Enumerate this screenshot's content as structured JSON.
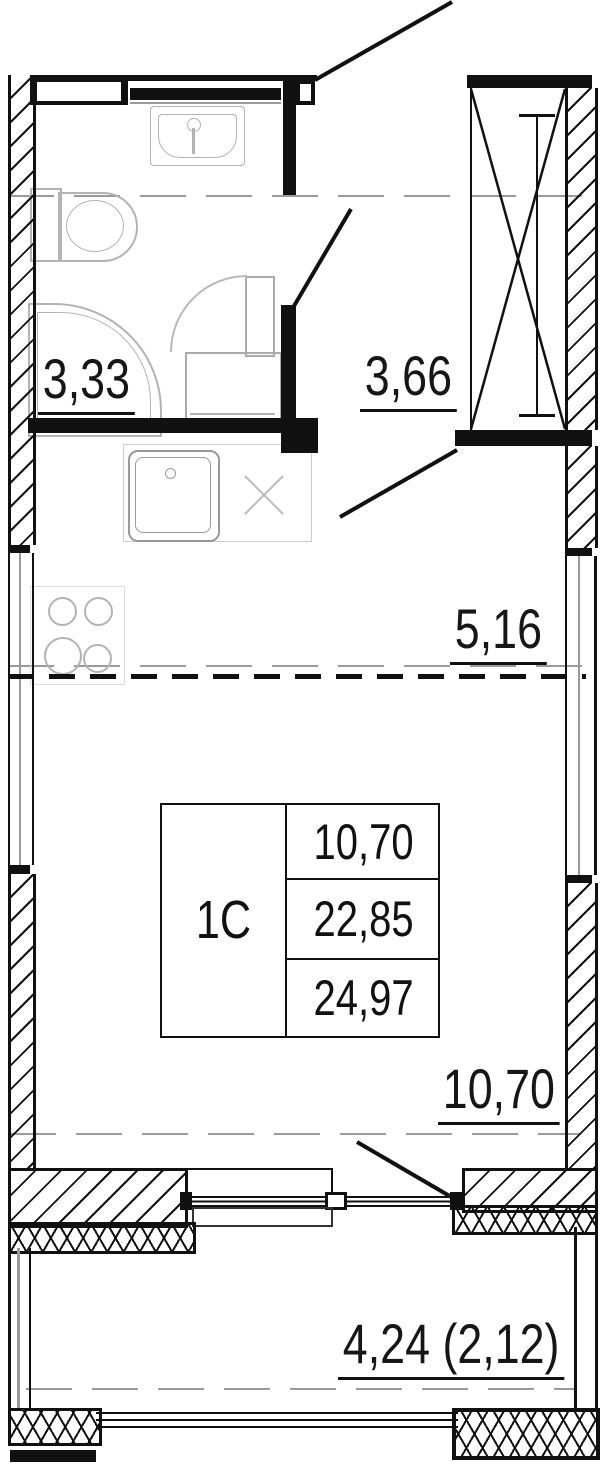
{
  "unit": {
    "type_label": "1С",
    "stats": {
      "row1": "10,70",
      "row2": "22,85",
      "row3": "24,97"
    }
  },
  "rooms": {
    "bathroom_area": "3,33",
    "hallway_area": "3,66",
    "kitchen_area": "5,16",
    "living_area": "10,70",
    "balcony_area": "4,24 (2,12)"
  },
  "colors": {
    "line": "#111111",
    "fixture": "#b3b3b3",
    "reference_dash": "#9a9a9a"
  }
}
